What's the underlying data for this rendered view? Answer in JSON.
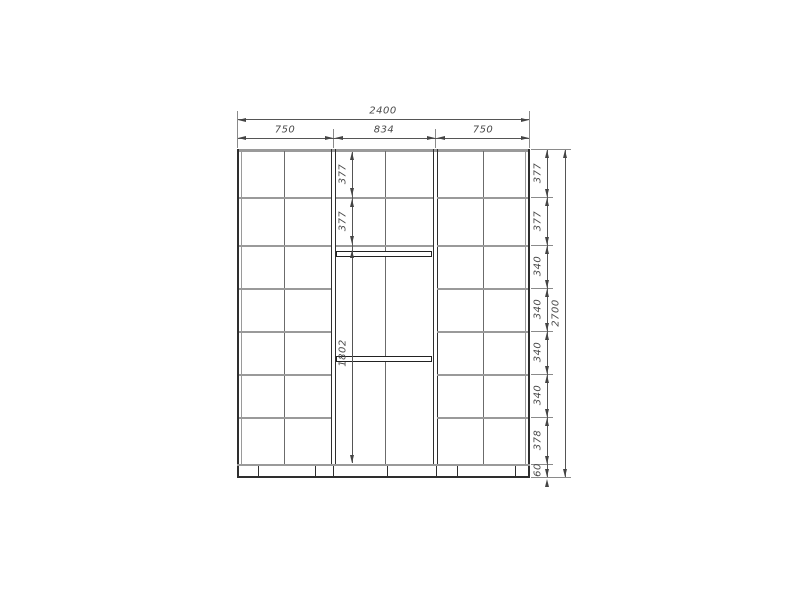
{
  "drawing": {
    "colors": {
      "line": "#4a4a4a",
      "light_line": "#9a9a9a",
      "dark_line": "#2e2e2e",
      "text": "#4a4a4a",
      "background": "#ffffff"
    }
  },
  "dimensions": {
    "total_width": "2400",
    "sections": [
      "750",
      "834",
      "750"
    ],
    "right_rows": [
      "377",
      "377",
      "340",
      "340",
      "340",
      "340",
      "378"
    ],
    "plinth_height": "60",
    "total_height": "2700",
    "middle_column": [
      "377",
      "377",
      "1802"
    ]
  }
}
